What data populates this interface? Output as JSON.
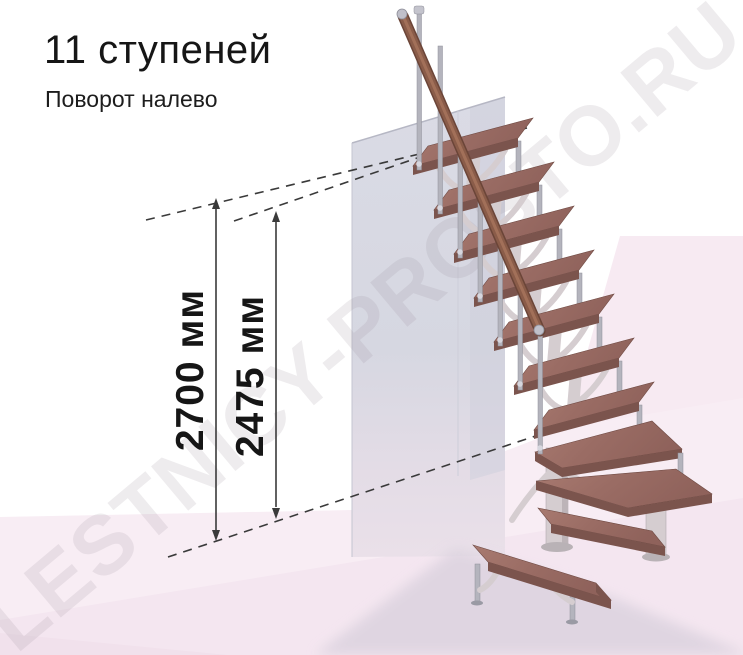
{
  "header": {
    "title": "11 ступеней",
    "subtitle": "Поворот налево"
  },
  "dimensions": {
    "overall_height": "2700 мм",
    "flight_height": "2475 мм"
  },
  "watermark": "LESTNICY-PROSTO.RU",
  "colors": {
    "ink": "#161616",
    "dim_line": "#3a3a3a",
    "wood": "#9c6e66",
    "wood_edge": "#7b544d",
    "handrail": "#8a5c49",
    "handrail_dark": "#6b4538",
    "steel": "#b4b4bd",
    "wall": "#d9dae4",
    "wall_shade": "#cfd0dc",
    "support": "#d5cdd0",
    "floor_pink": "#f8edf4",
    "floor_deep": "#f4e6f0",
    "right_pink": "#f7eaf2",
    "shadow": "#dcd3df",
    "watermark": "#9b8f98"
  }
}
